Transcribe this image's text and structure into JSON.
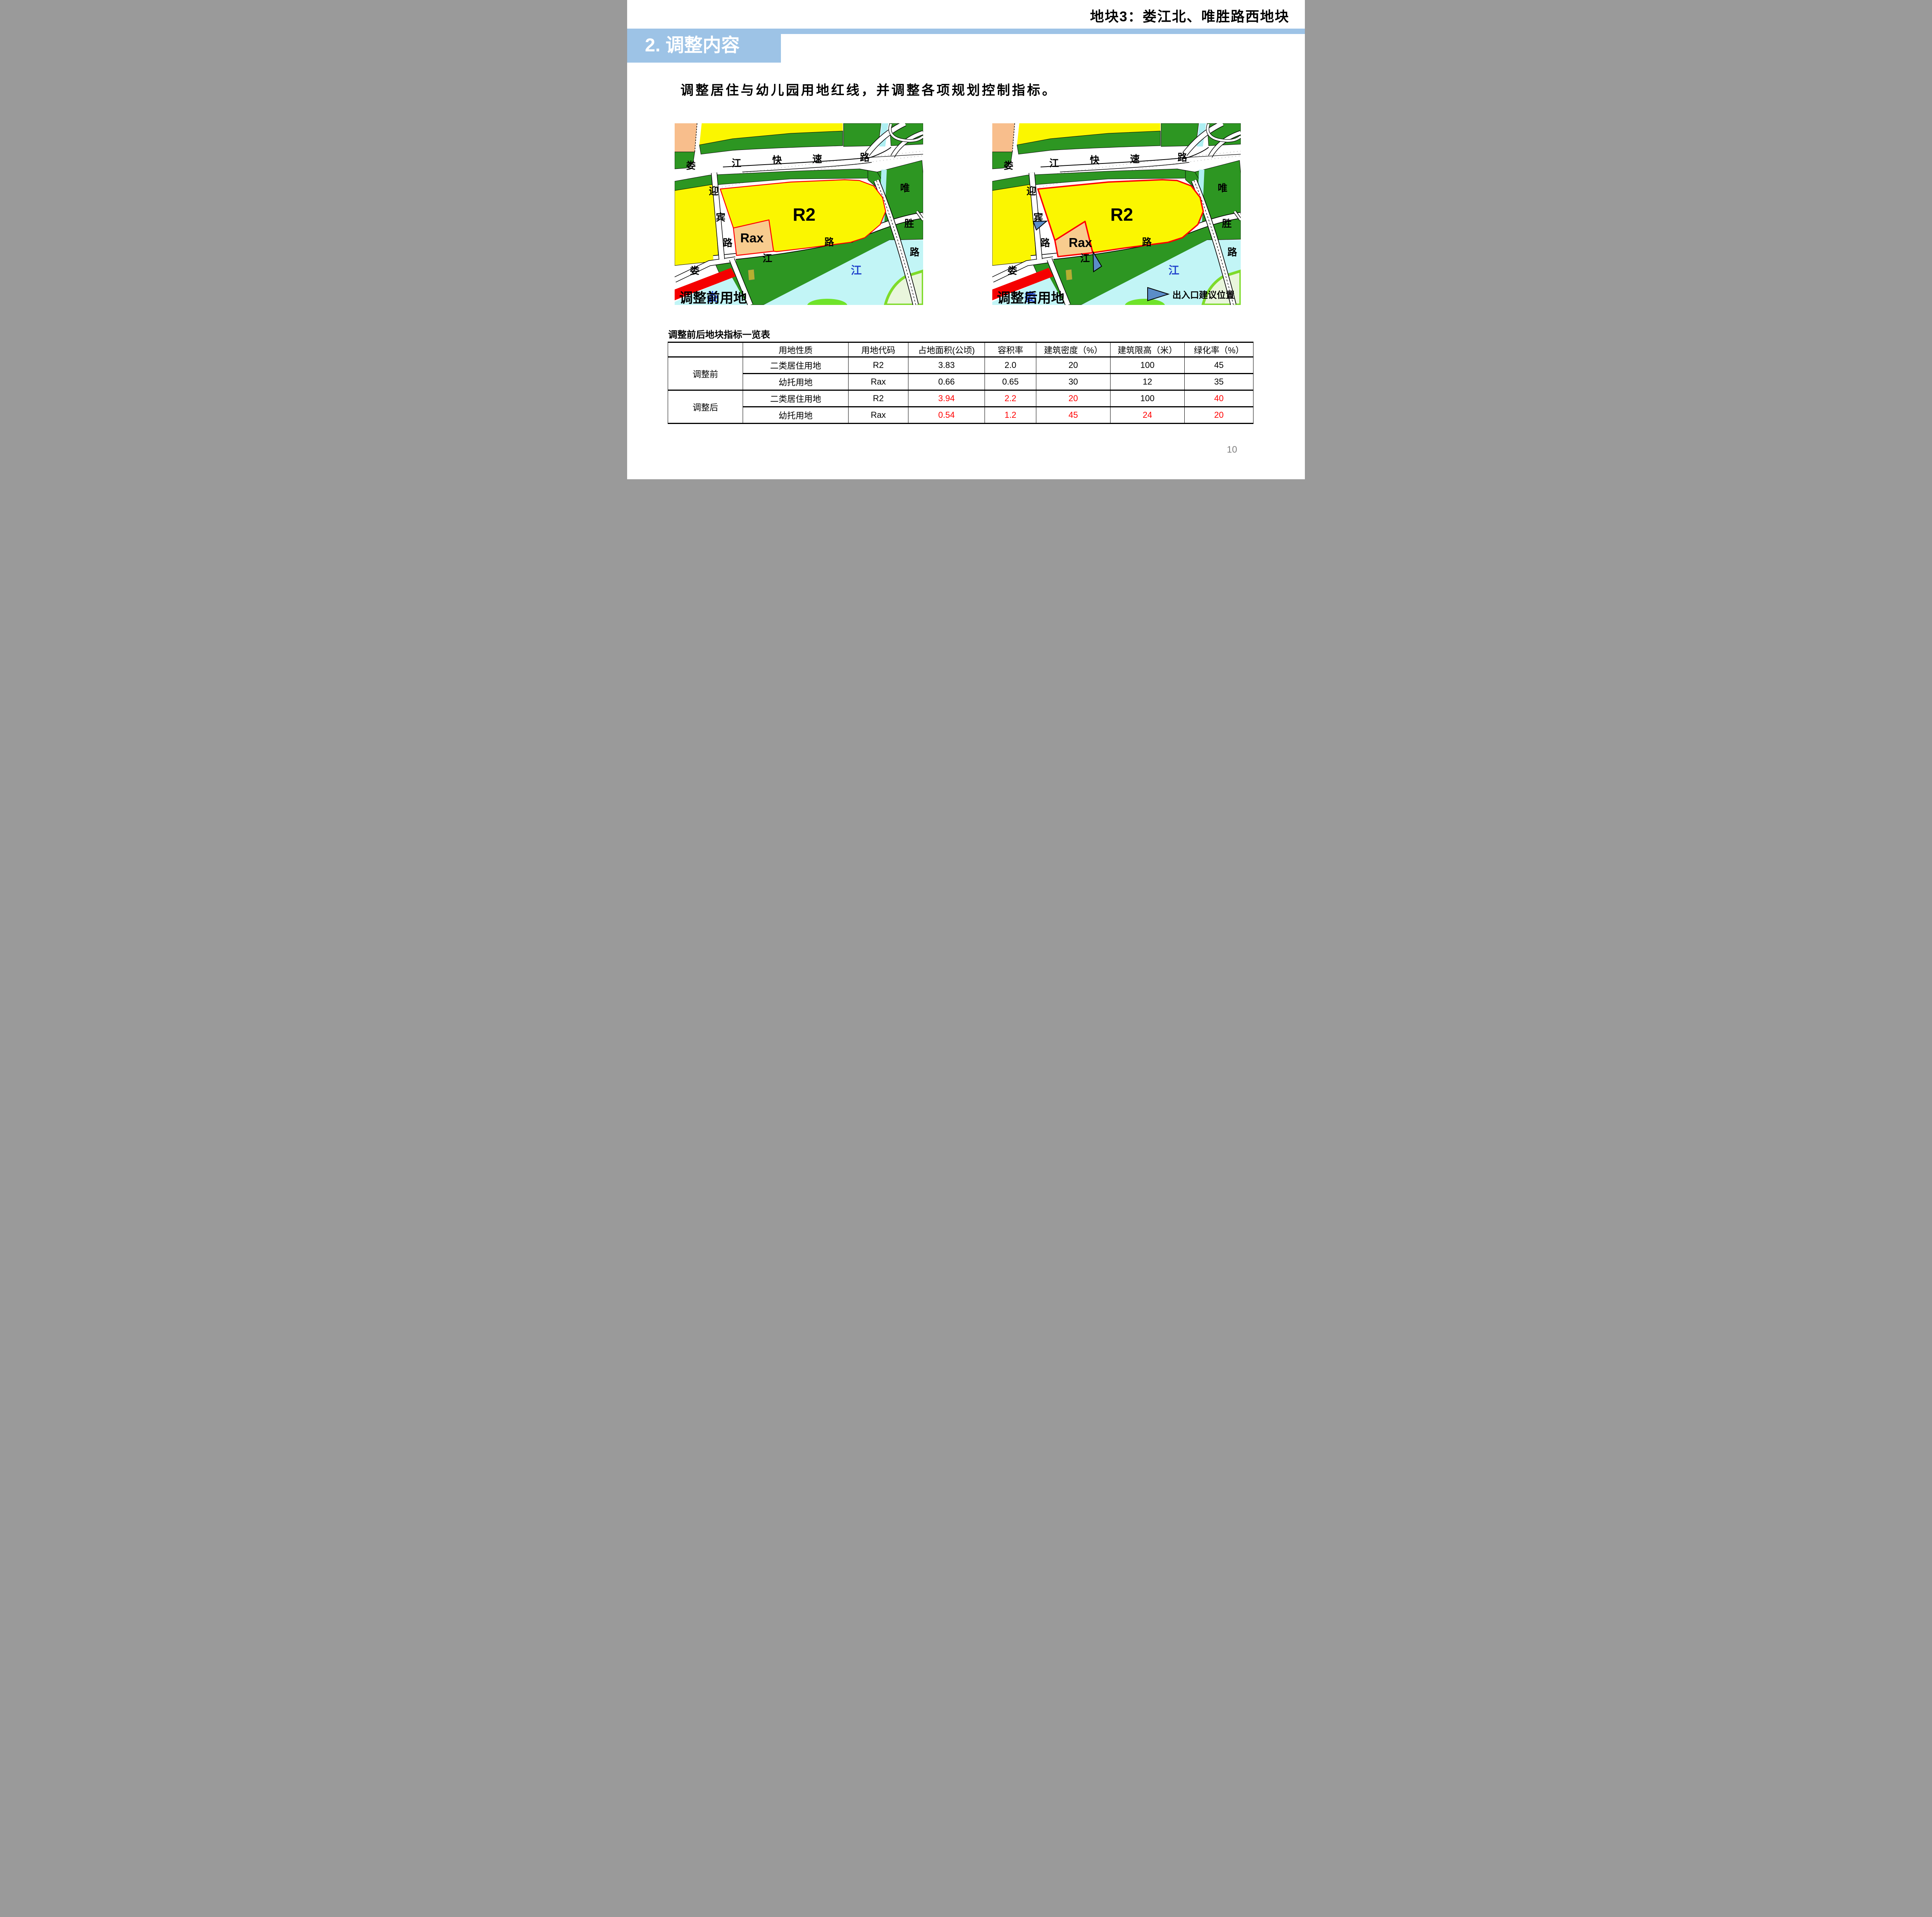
{
  "slide": {
    "title": "地块3：娄江北、唯胜路西地块",
    "section_header": "2. 调整内容",
    "subtitle": "调整居住与幼儿园用地红线，并调整各项规划控制指标。",
    "page_number": "10"
  },
  "colors": {
    "header_blue": "#9DC3E6",
    "parcel_yellow": "#FBF600",
    "parcel_green": "#2D9622",
    "parcel_orange": "#F8BE8C",
    "rax_orange": "#F8CC8E",
    "river_cyan": "#C2F5F6",
    "canal_cyan": "#AEEFF2",
    "boundary_red": "#FF0000",
    "red_parcel": "#F50000",
    "arrow_blue": "#5B8DC8",
    "table_highlight_red": "#FF0000"
  },
  "maps": {
    "left": {
      "caption": "调整前用地"
    },
    "right": {
      "caption": "调整后用地",
      "legend_label": "出入口建议位置"
    },
    "labels": {
      "expressway": [
        "娄",
        "江",
        "快",
        "速",
        "路"
      ],
      "yingbin_road": [
        "迎",
        "宾",
        "路"
      ],
      "weisheng_road": [
        "唯",
        "胜",
        "路"
      ],
      "riverside_road": [
        "娄",
        "江",
        "路"
      ],
      "river_name": "江",
      "lou_blue": "娄",
      "r2": "R2",
      "rax": "Rax"
    }
  },
  "table": {
    "caption": "调整前后地块指标一览表",
    "headers": [
      "",
      "用地性质",
      "用地代码",
      "占地面积(公顷)",
      "容积率",
      "建筑密度（%）",
      "建筑限高（米）",
      "绿化率（%）"
    ],
    "row_groups": [
      {
        "label": "调整前",
        "rows": [
          {
            "cells": [
              {
                "t": "二类居住用地"
              },
              {
                "t": "R2"
              },
              {
                "t": "3.83"
              },
              {
                "t": "2.0"
              },
              {
                "t": "20"
              },
              {
                "t": "100"
              },
              {
                "t": "45"
              }
            ]
          },
          {
            "cells": [
              {
                "t": "幼托用地"
              },
              {
                "t": "Rax"
              },
              {
                "t": "0.66"
              },
              {
                "t": "0.65"
              },
              {
                "t": "30"
              },
              {
                "t": "12"
              },
              {
                "t": "35"
              }
            ]
          }
        ]
      },
      {
        "label": "调整后",
        "rows": [
          {
            "cells": [
              {
                "t": "二类居住用地"
              },
              {
                "t": "R2"
              },
              {
                "t": "3.94",
                "red": true
              },
              {
                "t": "2.2",
                "red": true
              },
              {
                "t": "20",
                "red": true
              },
              {
                "t": "100"
              },
              {
                "t": "40",
                "red": true
              }
            ]
          },
          {
            "cells": [
              {
                "t": "幼托用地"
              },
              {
                "t": "Rax"
              },
              {
                "t": "0.54",
                "red": true
              },
              {
                "t": "1.2",
                "red": true
              },
              {
                "t": "45",
                "red": true
              },
              {
                "t": "24",
                "red": true
              },
              {
                "t": "20",
                "red": true
              }
            ]
          }
        ]
      }
    ]
  }
}
